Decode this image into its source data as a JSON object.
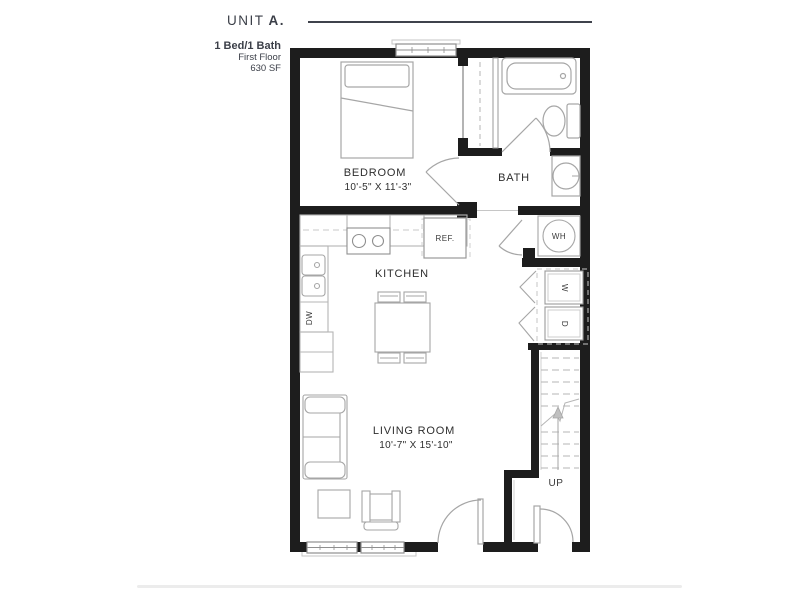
{
  "header": {
    "unit_prefix": "UNIT",
    "unit_letter": "A.",
    "specs": {
      "beds_baths": "1 Bed/1 Bath",
      "floor": "First Floor",
      "area": "630 SF"
    }
  },
  "plan": {
    "rooms": {
      "bedroom": {
        "name": "BEDROOM",
        "dims": "10'-5\" X 11'-3\""
      },
      "bath": {
        "name": "BATH"
      },
      "kitchen": {
        "name": "KITCHEN"
      },
      "living_room": {
        "name": "LIVING ROOM",
        "dims": "10'-7\" X 15'-10\""
      }
    },
    "labels": {
      "refrigerator": "REF.",
      "dishwasher": "DW",
      "water_heater": "WH",
      "washer": "W",
      "dryer": "D",
      "stairs_direction": "UP"
    }
  },
  "colors": {
    "wall": "#1d1d1d",
    "fixture_line": "#a6a6a6",
    "appliance_line": "#8f8f8f",
    "light_line": "#c6c6c6",
    "label_text": "#2e2e2e",
    "header_text": "#3b3f48",
    "footer_divider": "#ececec"
  }
}
